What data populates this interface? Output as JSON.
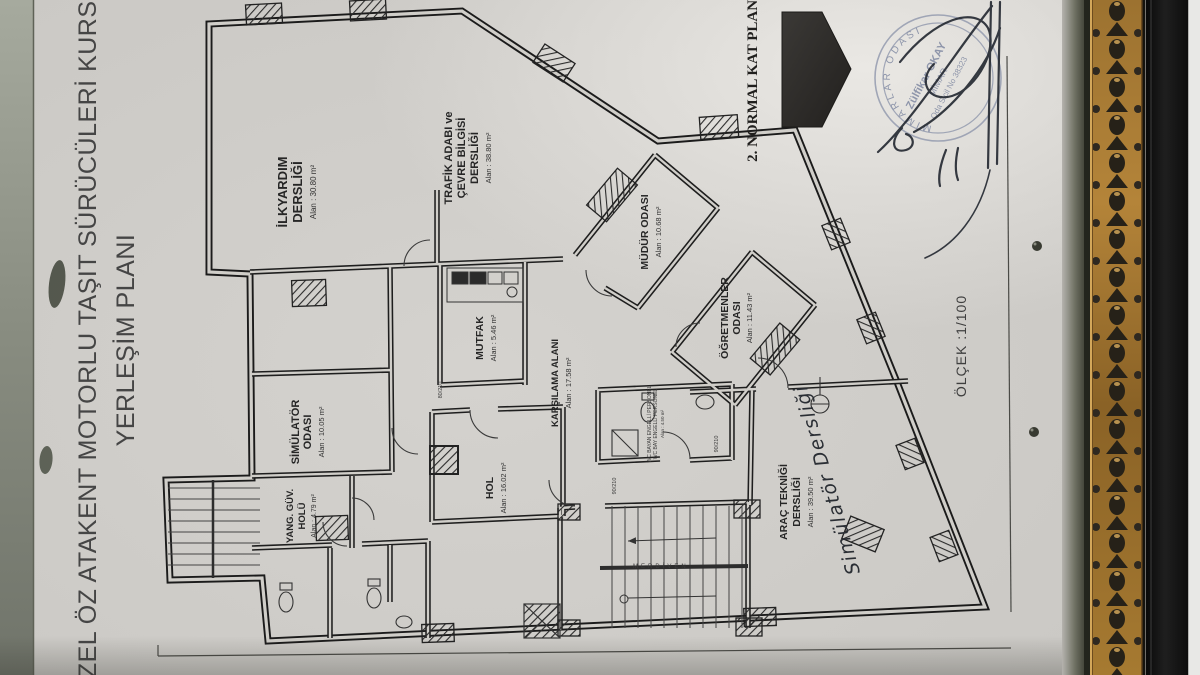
{
  "title": {
    "line1": "ÖZEL ÖZ ATAKENT MOTORLU TAŞIT SÜRÜCÜLERİ KURSU",
    "line2": "YERLEŞİM PLANI"
  },
  "plan": {
    "heading": "2. NORMAL KAT PLANI",
    "scale": "ÖLÇEK :1/100",
    "rooms": {
      "ilkyardim": {
        "line1": "İLKYARDIM",
        "line2": "DERSLİĞİ",
        "area": "Alan : 30.80 m²"
      },
      "trafik": {
        "line1": "TRAFİK ADABI ve",
        "line2": "ÇEVRE BİLGİSİ",
        "line3": "DERSLİĞİ",
        "area": "Alan : 38.80 m²"
      },
      "mudur": {
        "line1": "MÜDÜR ODASI",
        "area": "Alan : 10.68 m²"
      },
      "ogretmenler": {
        "line1": "ÖĞRETMENLER",
        "line2": "ODASI",
        "area": "Alan : 11.43 m²"
      },
      "mutfak": {
        "line1": "MUTFAK",
        "area": "Alan : 5.46 m²"
      },
      "karsilama": {
        "line1": "KARŞILAMA ALANI",
        "area": "Alan : 17.58 m²"
      },
      "simulator": {
        "line1": "SİMÜLATÖR",
        "line2": "ODASI",
        "area": "Alan : 10.05 m²"
      },
      "hol": {
        "line1": "HOL",
        "area": "Alan : 16.02 m²"
      },
      "yangin": {
        "line1": "YANG. GÜV.",
        "line2": "HOLÜ",
        "area": "Alan : 4.79 m²"
      },
      "arac": {
        "line1": "ARAÇ TEKNİĞİ",
        "line2": "DERSLİĞİ",
        "area": "Alan : 39.50 m²"
      },
      "wc": {
        "line1": "WC BAYAN ENGELLİ PERSONEL",
        "line2": "WC BAY ENGELLİ PERSONEL",
        "area": "Alan : 4.50 m²"
      }
    },
    "annotations": {
      "handwritten_note": "Simülatör Dersliği",
      "stair_label": "MERDİVEN",
      "door_dim_1": "90/210",
      "door_dim_2": "90/210",
      "door_dim_3": "80/210"
    }
  },
  "stamp": {
    "organization": "MİMARLAR ODASI",
    "name": "Zülfikar OKAY",
    "profession": "MİMAR",
    "registration": "Oda Sicil No 38323"
  },
  "colors": {
    "paper": "#d0cec9",
    "ink": "#1c1c1c",
    "signature_ink": "#222730",
    "stamp_ink": "#76809c",
    "frame_gold": "#a0752f",
    "frame_black": "#111111"
  }
}
